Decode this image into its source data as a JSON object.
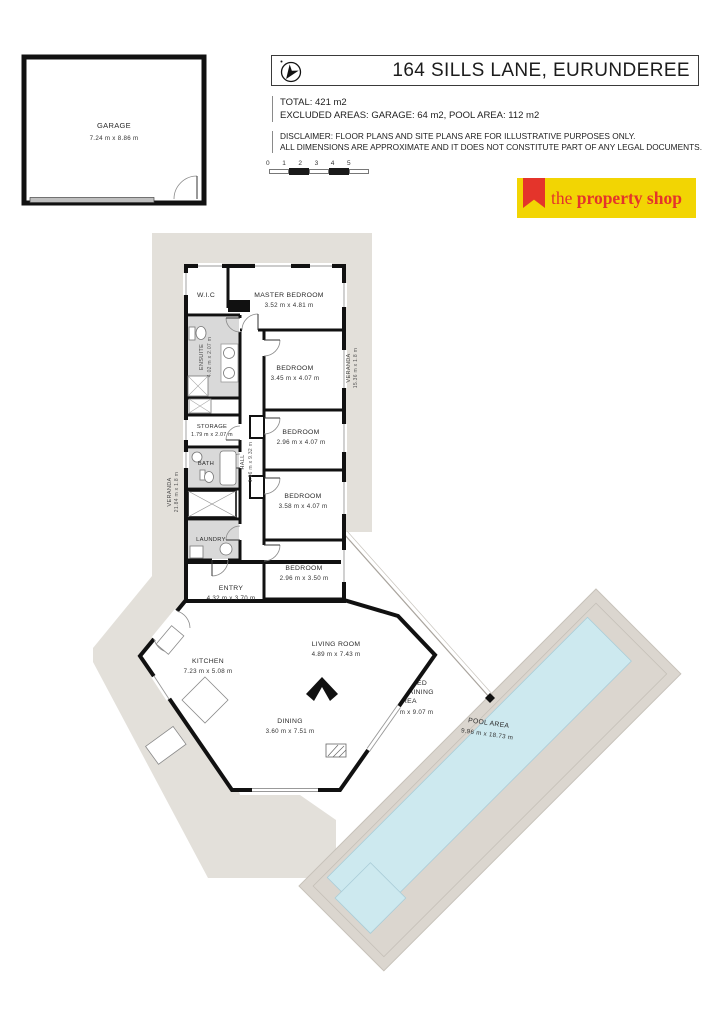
{
  "header": {
    "title": "164 SILLS LANE, EURUNDEREE",
    "compass_icon": "north-arrow"
  },
  "summary": {
    "total": "TOTAL: 421 m2",
    "excluded": "EXCLUDED AREAS: GARAGE: 64 m2, POOL AREA: 112 m2"
  },
  "disclaimer": {
    "line1": "DISCLAIMER: FLOOR PLANS AND SITE PLANS ARE FOR ILLUSTRATIVE PURPOSES ONLY.",
    "line2": "ALL DIMENSIONS ARE APPROXIMATE AND IT DOES NOT CONSTITUTE PART OF ANY LEGAL DOCUMENTS."
  },
  "scale_bar": {
    "labels": [
      "0",
      "1",
      "2",
      "3",
      "4",
      "5"
    ]
  },
  "logo": {
    "the": "the ",
    "name": "property shop",
    "yellow": "#f2d503",
    "red": "#e4342b"
  },
  "colors": {
    "wall": "#111111",
    "veranda": "#e3e0da",
    "pool_surround": "#dbd6cf",
    "pool_water": "#cde9ef",
    "wet_area": "#d9d9d9"
  },
  "rooms": {
    "garage": {
      "name": "GARAGE",
      "dims": "7.24 m x 8.86 m"
    },
    "wic": {
      "name": "W.I.C"
    },
    "master_bedroom": {
      "name": "MASTER BEDROOM",
      "dims": "3.52 m x 4.81 m"
    },
    "bedroom2": {
      "name": "BEDROOM",
      "dims": "3.45 m x 4.07 m"
    },
    "bedroom3": {
      "name": "BEDROOM",
      "dims": "2.96 m x 4.07 m"
    },
    "bedroom4": {
      "name": "BEDROOM",
      "dims": "3.58 m x 4.07 m"
    },
    "bedroom5": {
      "name": "BEDROOM",
      "dims": "2.96 m x 3.50 m"
    },
    "storage": {
      "name": "STORAGE",
      "dims": "1.79 m x 2.07 m"
    },
    "bath": {
      "name": "BATH"
    },
    "laundry": {
      "name": "LAUNDRY"
    },
    "ensuite": {
      "name": "ENSUITE",
      "dims": "4.02 m x 2.07 m"
    },
    "hall": {
      "name": "HALL",
      "dims": "1.06 m x 9.32 m"
    },
    "entry": {
      "name": "ENTRY",
      "dims": "4.32 m x 3.70 m"
    },
    "kitchen": {
      "name": "KITCHEN",
      "dims": "7.23 m x 5.08 m"
    },
    "living_room": {
      "name": "LIVING ROOM",
      "dims": "4.89 m x 7.43 m"
    },
    "dining": {
      "name": "DINING",
      "dims": "3.60 m x 7.51 m"
    },
    "screened_entertaining": {
      "line1": "SCREENED",
      "line2": "ENTERTAINING",
      "line3": "AREA",
      "dims": "14.64 m x  9.07 m"
    },
    "pool_area": {
      "name": "POOL AREA",
      "dims": "9.96 m x 18.73 m"
    },
    "veranda_right": {
      "name": "VERANDA",
      "dims": "15.36 m x 1.8 m"
    },
    "veranda_left": {
      "name": "VERANDA",
      "dims": "21.84 m x 1.8 m"
    }
  }
}
